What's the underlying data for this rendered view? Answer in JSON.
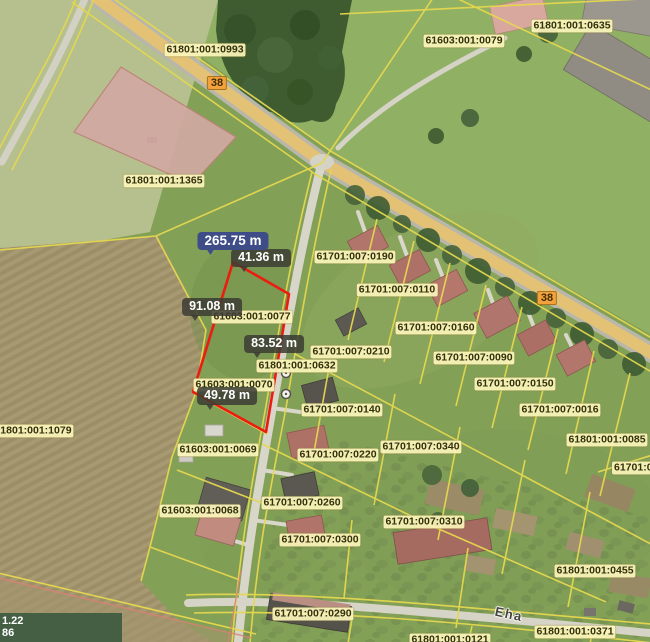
{
  "map": {
    "parcel_labels": [
      {
        "text": "61801:001:0993",
        "x": 205,
        "y": 50
      },
      {
        "text": "61603:001:0079",
        "x": 464,
        "y": 41
      },
      {
        "text": "61801:001:0635",
        "x": 572,
        "y": 26
      },
      {
        "text": "61801:001:1365",
        "x": 164,
        "y": 181
      },
      {
        "text": "61701:007:0190",
        "x": 355,
        "y": 257
      },
      {
        "text": "61701:007:0110",
        "x": 397,
        "y": 290
      },
      {
        "text": "61603:001:0077",
        "x": 252,
        "y": 317
      },
      {
        "text": "61701:007:0160",
        "x": 436,
        "y": 328
      },
      {
        "text": "61701:007:0210",
        "x": 351,
        "y": 352
      },
      {
        "text": "61701:007:0090",
        "x": 474,
        "y": 358
      },
      {
        "text": "61801:001:0632",
        "x": 297,
        "y": 366
      },
      {
        "text": "61701:007:0150",
        "x": 515,
        "y": 384
      },
      {
        "text": "61603:001:0070",
        "x": 234,
        "y": 385
      },
      {
        "text": "61701:007:0140",
        "x": 342,
        "y": 410
      },
      {
        "text": "61701:007:0016",
        "x": 560,
        "y": 410
      },
      {
        "text": "61801:001:1079",
        "x": 33,
        "y": 431
      },
      {
        "text": "61801:001:0085",
        "x": 607,
        "y": 440
      },
      {
        "text": "61701:007:0340",
        "x": 421,
        "y": 447
      },
      {
        "text": "61603:001:0069",
        "x": 218,
        "y": 450
      },
      {
        "text": "61701:007:0220",
        "x": 338,
        "y": 455
      },
      {
        "text": "61701:007:0",
        "x": 612,
        "y": 468,
        "align": "left"
      },
      {
        "text": "61701:007:0260",
        "x": 302,
        "y": 503
      },
      {
        "text": "61603:001:0068",
        "x": 200,
        "y": 511
      },
      {
        "text": "61701:007:0310",
        "x": 424,
        "y": 522
      },
      {
        "text": "61701:007:0300",
        "x": 320,
        "y": 540
      },
      {
        "text": "61801:001:0455",
        "x": 595,
        "y": 571
      },
      {
        "text": "61701:007:0290",
        "x": 313,
        "y": 614
      },
      {
        "text": "61801:001:0371",
        "x": 575,
        "y": 632
      },
      {
        "text": "61801:001:0121",
        "x": 450,
        "y": 640
      }
    ],
    "road_badges": [
      {
        "text": "38",
        "x": 217,
        "y": 83
      },
      {
        "text": "38",
        "x": 547,
        "y": 298
      }
    ],
    "street_labels": [
      {
        "text": "Eha",
        "x": 509,
        "y": 614,
        "rot": 12
      }
    ],
    "measurements": {
      "total": {
        "text": "265.75 m",
        "x": 233,
        "y": 241
      },
      "segments": [
        {
          "text": "41.36 m",
          "x": 261,
          "y": 258
        },
        {
          "text": "91.08 m",
          "x": 212,
          "y": 307
        },
        {
          "text": "83.52 m",
          "x": 274,
          "y": 344
        },
        {
          "text": "49.78 m",
          "x": 227,
          "y": 396
        }
      ]
    },
    "coordinate_readout": {
      "line1": "1.22",
      "line2": "86"
    },
    "colors": {
      "selection": "#ec1c10",
      "boundary": "#e6d84f",
      "label_bg": "rgba(252,245,187,0.92)",
      "label_text": "#33300d",
      "badge_bg": "rgba(60,60,52,0.85)",
      "total_badge_bg": "#3e4d87",
      "road_badge_bg": "#f2a13c"
    }
  }
}
